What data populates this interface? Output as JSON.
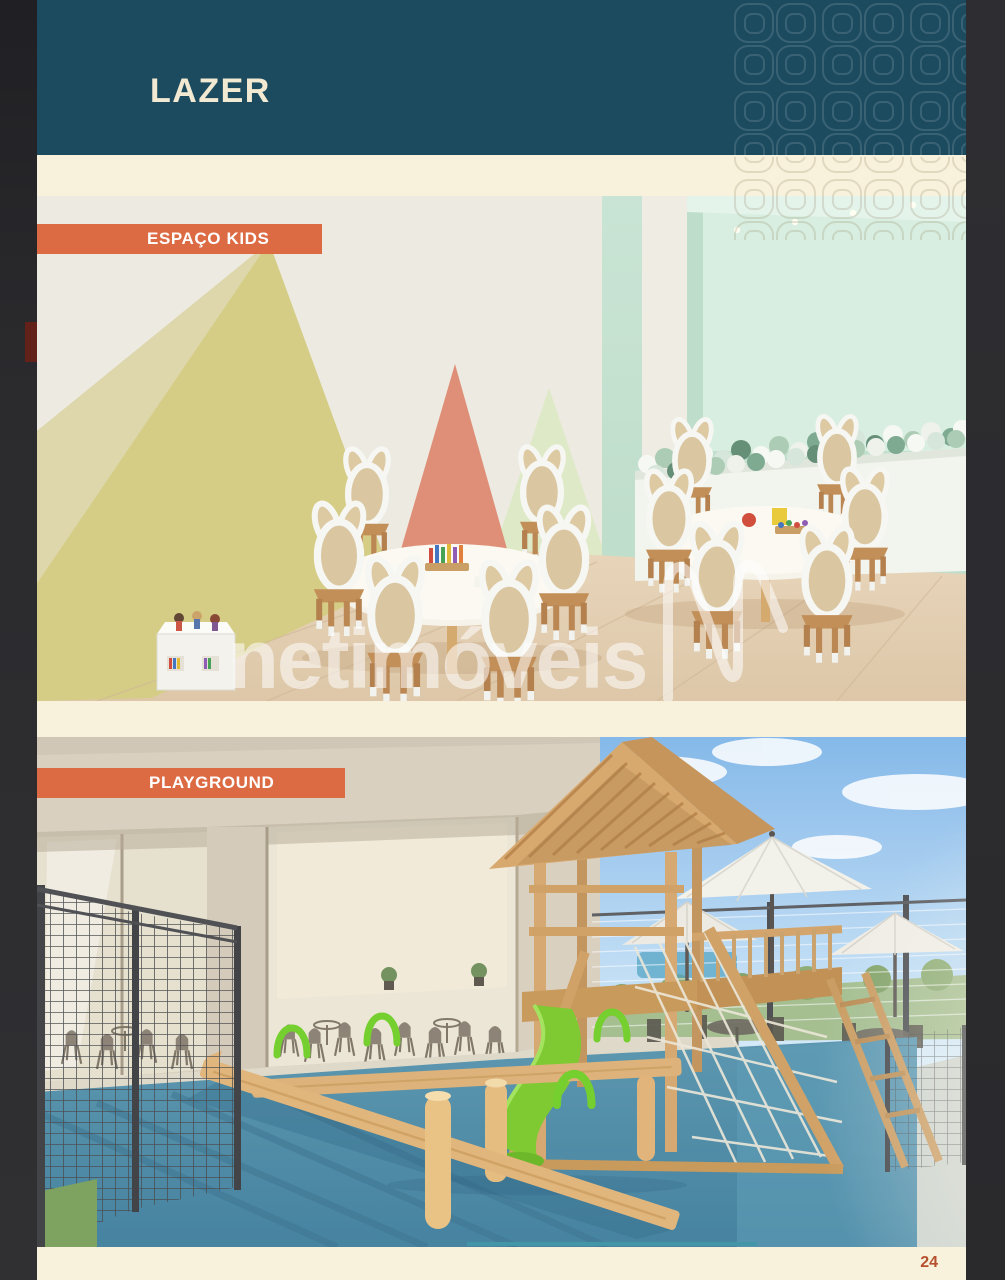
{
  "document": {
    "title": "LAZER",
    "page_number": "24",
    "watermark_text": "netimóveis",
    "sections": [
      {
        "label": "ESPAÇO KIDS"
      },
      {
        "label": "PLAYGROUND"
      }
    ]
  },
  "colors": {
    "header_teal": "#1c4b5f",
    "page_cream": "#f8f1db",
    "label_orange": "#dc6a43",
    "page_number_color": "#b5502f",
    "frame_dark_right": "#2c2c2e",
    "accent_red": "#62221a"
  },
  "icons": {
    "decor_pattern": "clover-tile-pattern",
    "watermark_logo": "netimoveis-n-logo"
  }
}
